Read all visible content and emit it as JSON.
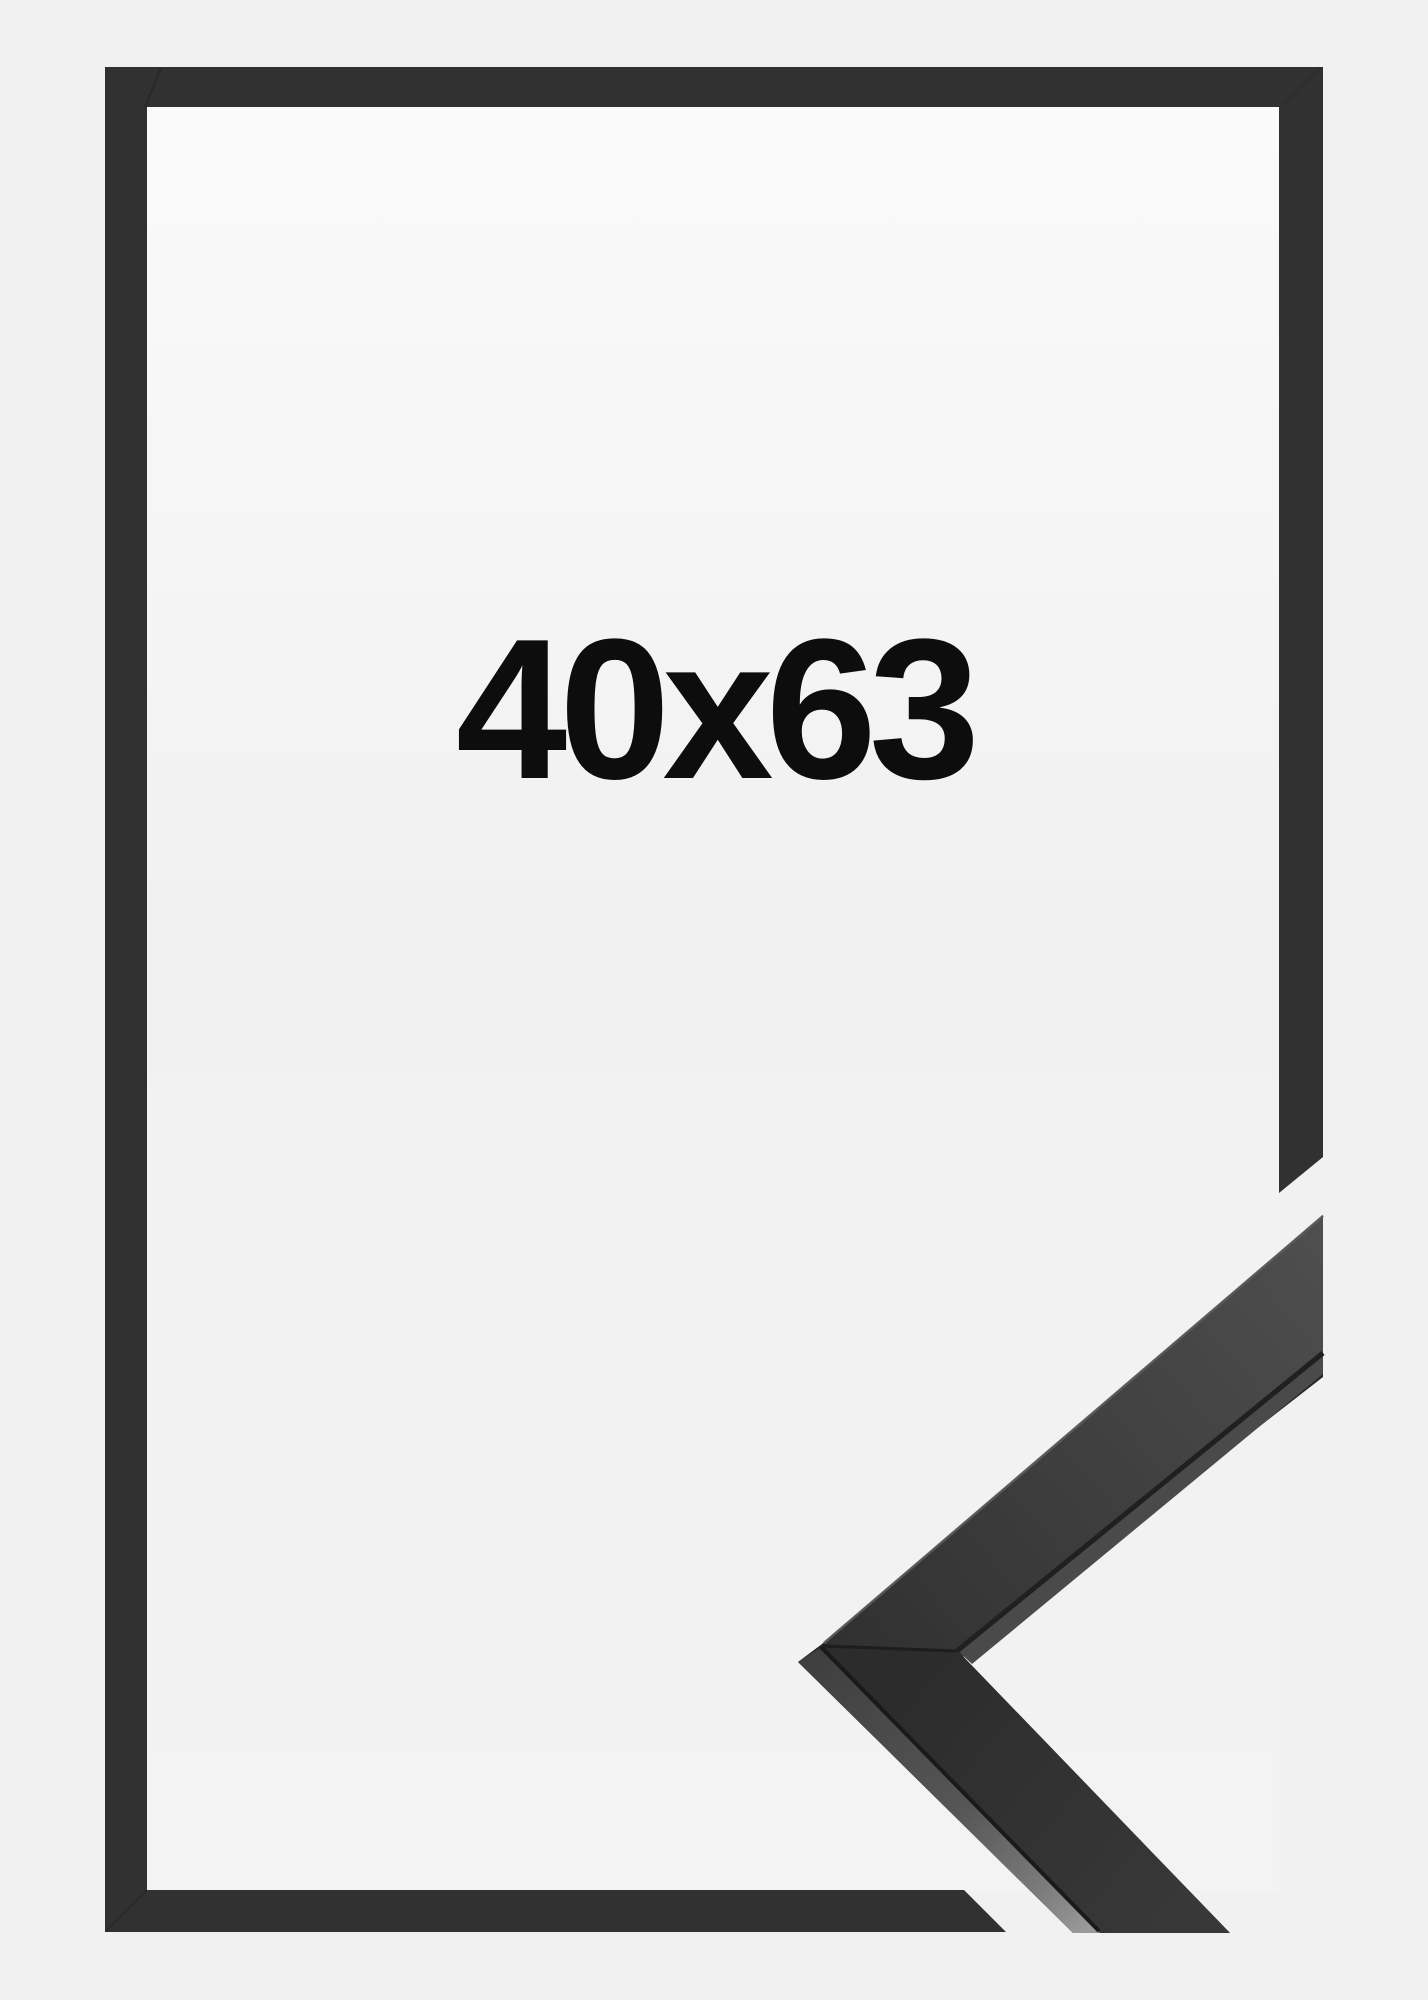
{
  "page": {
    "background_color": "#f1f1f2"
  },
  "product": {
    "size_label": "40x63",
    "label_color": "#0d0d0d",
    "frame_color": "#313131",
    "inner_area_top_color": "#fafafa",
    "inner_area_bottom_color": "#f2f2f2",
    "profile_face_dark_color": "#2c2c2c",
    "profile_face_light_color": "#4f4f4f",
    "profile_side_light_color": "#9a9a9a"
  }
}
